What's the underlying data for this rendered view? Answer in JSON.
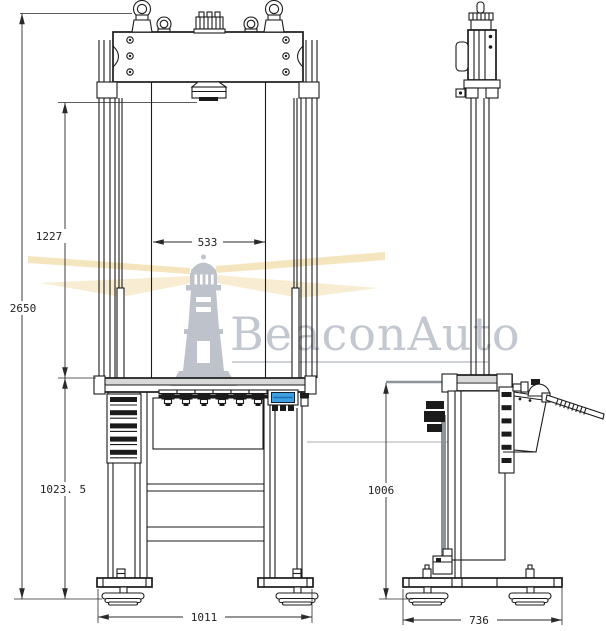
{
  "watermark": {
    "brand": "BeaconAuto"
  },
  "dimensions": {
    "front": {
      "overall_height": "2650",
      "daylight": "1227",
      "column_clearance": "533",
      "table_height": "1023. 5",
      "base_width": "1011"
    },
    "side": {
      "table_height": "1006",
      "base_depth": "736"
    }
  },
  "colors": {
    "line": "#1b1b1b",
    "dim_line": "#2a2a2a",
    "display_screen": "#3f9fe0",
    "display_screen_dark": "#1b6fb0",
    "table_fill": "#d8d8d8",
    "shade_gray": "#8d939b",
    "watermark_text": "#b9bec7",
    "lighthouse": "#b2b8c2",
    "beam": "#f0d8a0"
  }
}
